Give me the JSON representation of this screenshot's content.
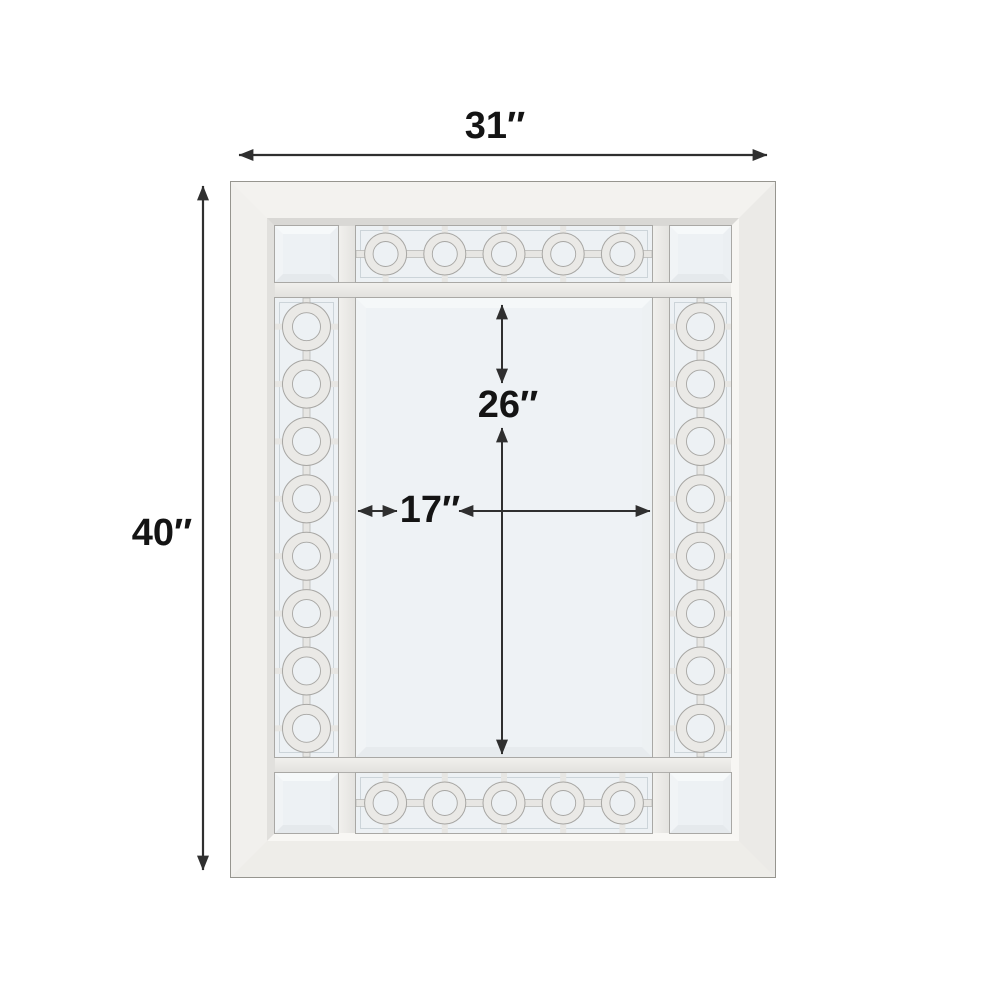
{
  "diagram": {
    "type": "product-dimension-diagram",
    "background": "#ffffff",
    "annotation_color": "#2f2f2f",
    "label_color": "#141414"
  },
  "dimensions": {
    "overall_width": {
      "label": "31″"
    },
    "overall_height": {
      "label": "40″"
    },
    "inner_mirror_height": {
      "label": "26″"
    },
    "inner_mirror_width": {
      "label": "17″"
    }
  },
  "mirror": {
    "frame_color": "#f1f0ed",
    "glass_color": "#edf1f4",
    "ring_color": "#eae9e6",
    "bar_color": "#e7e6e3",
    "outline_color": "#a7a6a3",
    "pattern": {
      "top_band_circles": 5,
      "bottom_band_circles": 5,
      "left_band_circles": 8,
      "right_band_circles": 8
    }
  }
}
